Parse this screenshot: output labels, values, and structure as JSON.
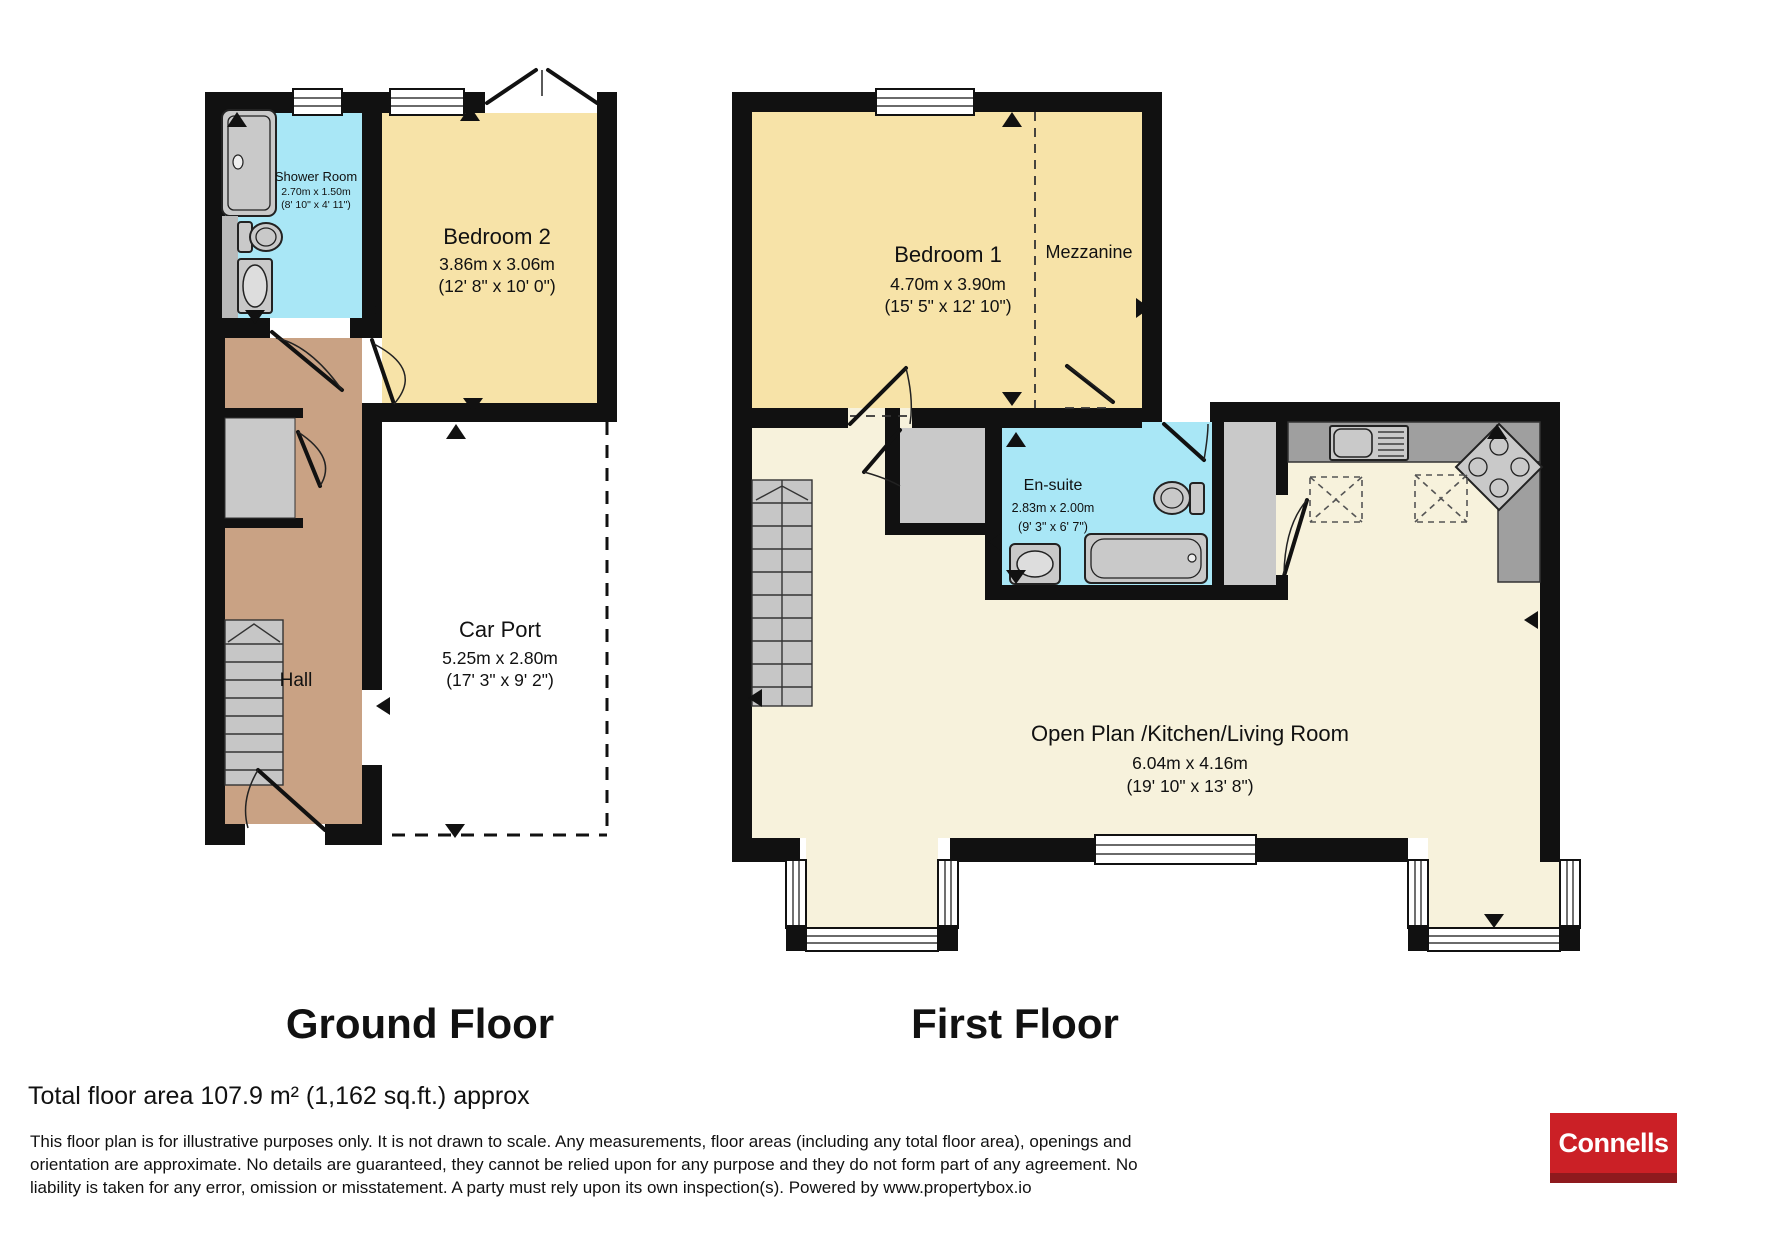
{
  "floors": [
    {
      "title": "Ground Floor",
      "rooms": {
        "shower_room": {
          "name": "Shower Room",
          "dim_m": "2.70m x 1.50m",
          "dim_ft": "(8' 10\" x 4' 11\")"
        },
        "bedroom2": {
          "name": "Bedroom 2",
          "dim_m": "3.86m x 3.06m",
          "dim_ft": "(12' 8\" x 10' 0\")"
        },
        "hall": {
          "name": "Hall"
        },
        "car_port": {
          "name": "Car Port",
          "dim_m": "5.25m x 2.80m",
          "dim_ft": "(17' 3\" x 9' 2\")"
        }
      }
    },
    {
      "title": "First Floor",
      "rooms": {
        "bedroom1": {
          "name": "Bedroom 1",
          "dim_m": "4.70m x 3.90m",
          "dim_ft": "(15' 5\" x 12' 10\")"
        },
        "mezzanine": {
          "name": "Mezzanine"
        },
        "ensuite": {
          "name": "En-suite",
          "dim_m": "2.83m x 2.00m",
          "dim_ft": "(9' 3\" x 6' 7\")"
        },
        "open_plan": {
          "name": "Open Plan /Kitchen/Living Room",
          "dim_m": "6.04m x 4.16m",
          "dim_ft": "(19' 10\" x 13' 8\")"
        }
      }
    }
  ],
  "footer": {
    "total_area": "Total floor area 107.9 m² (1,162 sq.ft.) approx",
    "disclaimer_lines": [
      "This floor plan is for illustrative purposes only. It is not drawn to scale. Any measurements, floor areas (including any total floor area), openings and",
      "orientation are approximate. No details are guaranteed, they cannot be relied upon for any purpose and they do not form part of any agreement. No",
      "liability is taken for any error, omission or misstatement. A party must rely upon its own inspection(s). Powered by www.propertybox.io"
    ]
  },
  "logo": {
    "text": "Connells"
  },
  "colors": {
    "wall": "#111111",
    "bedroom_fill": "#f7e3a8",
    "living_fill": "#f7f2dc",
    "bath_fill": "#a9e7f6",
    "hall_fill": "#c9a284",
    "fixture_gray": "#c9c9c9",
    "counter_gray": "#9f9f9f",
    "logo_red": "#cb2026",
    "logo_dark_red": "#8e1a1e"
  }
}
